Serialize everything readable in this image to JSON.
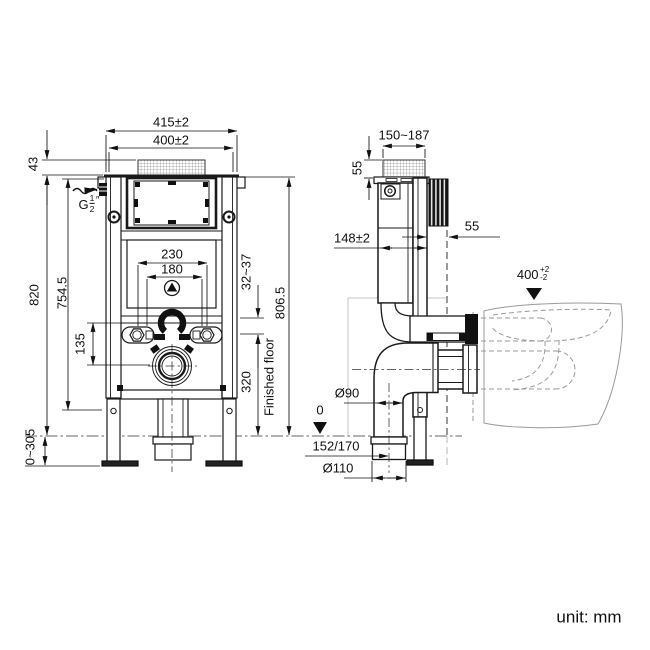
{
  "front": {
    "dim_frame_width_outer": "415±2",
    "dim_flush_plate_width": "400±2",
    "dim_top_section_height": "43",
    "water_inlet": {
      "prefix": "G",
      "numerator": "1",
      "denominator": "2",
      "suffix": "″"
    },
    "dim_frame_height": "820",
    "dim_inner_height": "754.5",
    "dim_fixing_span_outer": "230",
    "dim_fixing_span_inner": "180",
    "dim_drain_offset": "135",
    "dim_bracket_range": "32~37",
    "dim_height_above_floor": "806.5",
    "floor_label": "Finished floor",
    "dim_outlet_height": "320",
    "dim_foot_adjustment": "0~305"
  },
  "side": {
    "dim_depth_range": "150~187",
    "dim_shaft_height": "55",
    "dim_cistern_depth": "148±2",
    "dim_wall_clearance": "55",
    "seat_height_datum": {
      "value": "400",
      "tol_plus": "+2",
      "tol_minus": "-2"
    },
    "dim_drain_pipe_diameter": "Ø90",
    "floor_datum": "0",
    "dim_outlet_offset": "152/170",
    "dim_collar_diameter": "Ø110"
  },
  "footer": {
    "unit_label": "unit: mm"
  },
  "colors": {
    "line": "#111111",
    "ghost": "#9a9a9a",
    "accent_black": "#141414"
  }
}
